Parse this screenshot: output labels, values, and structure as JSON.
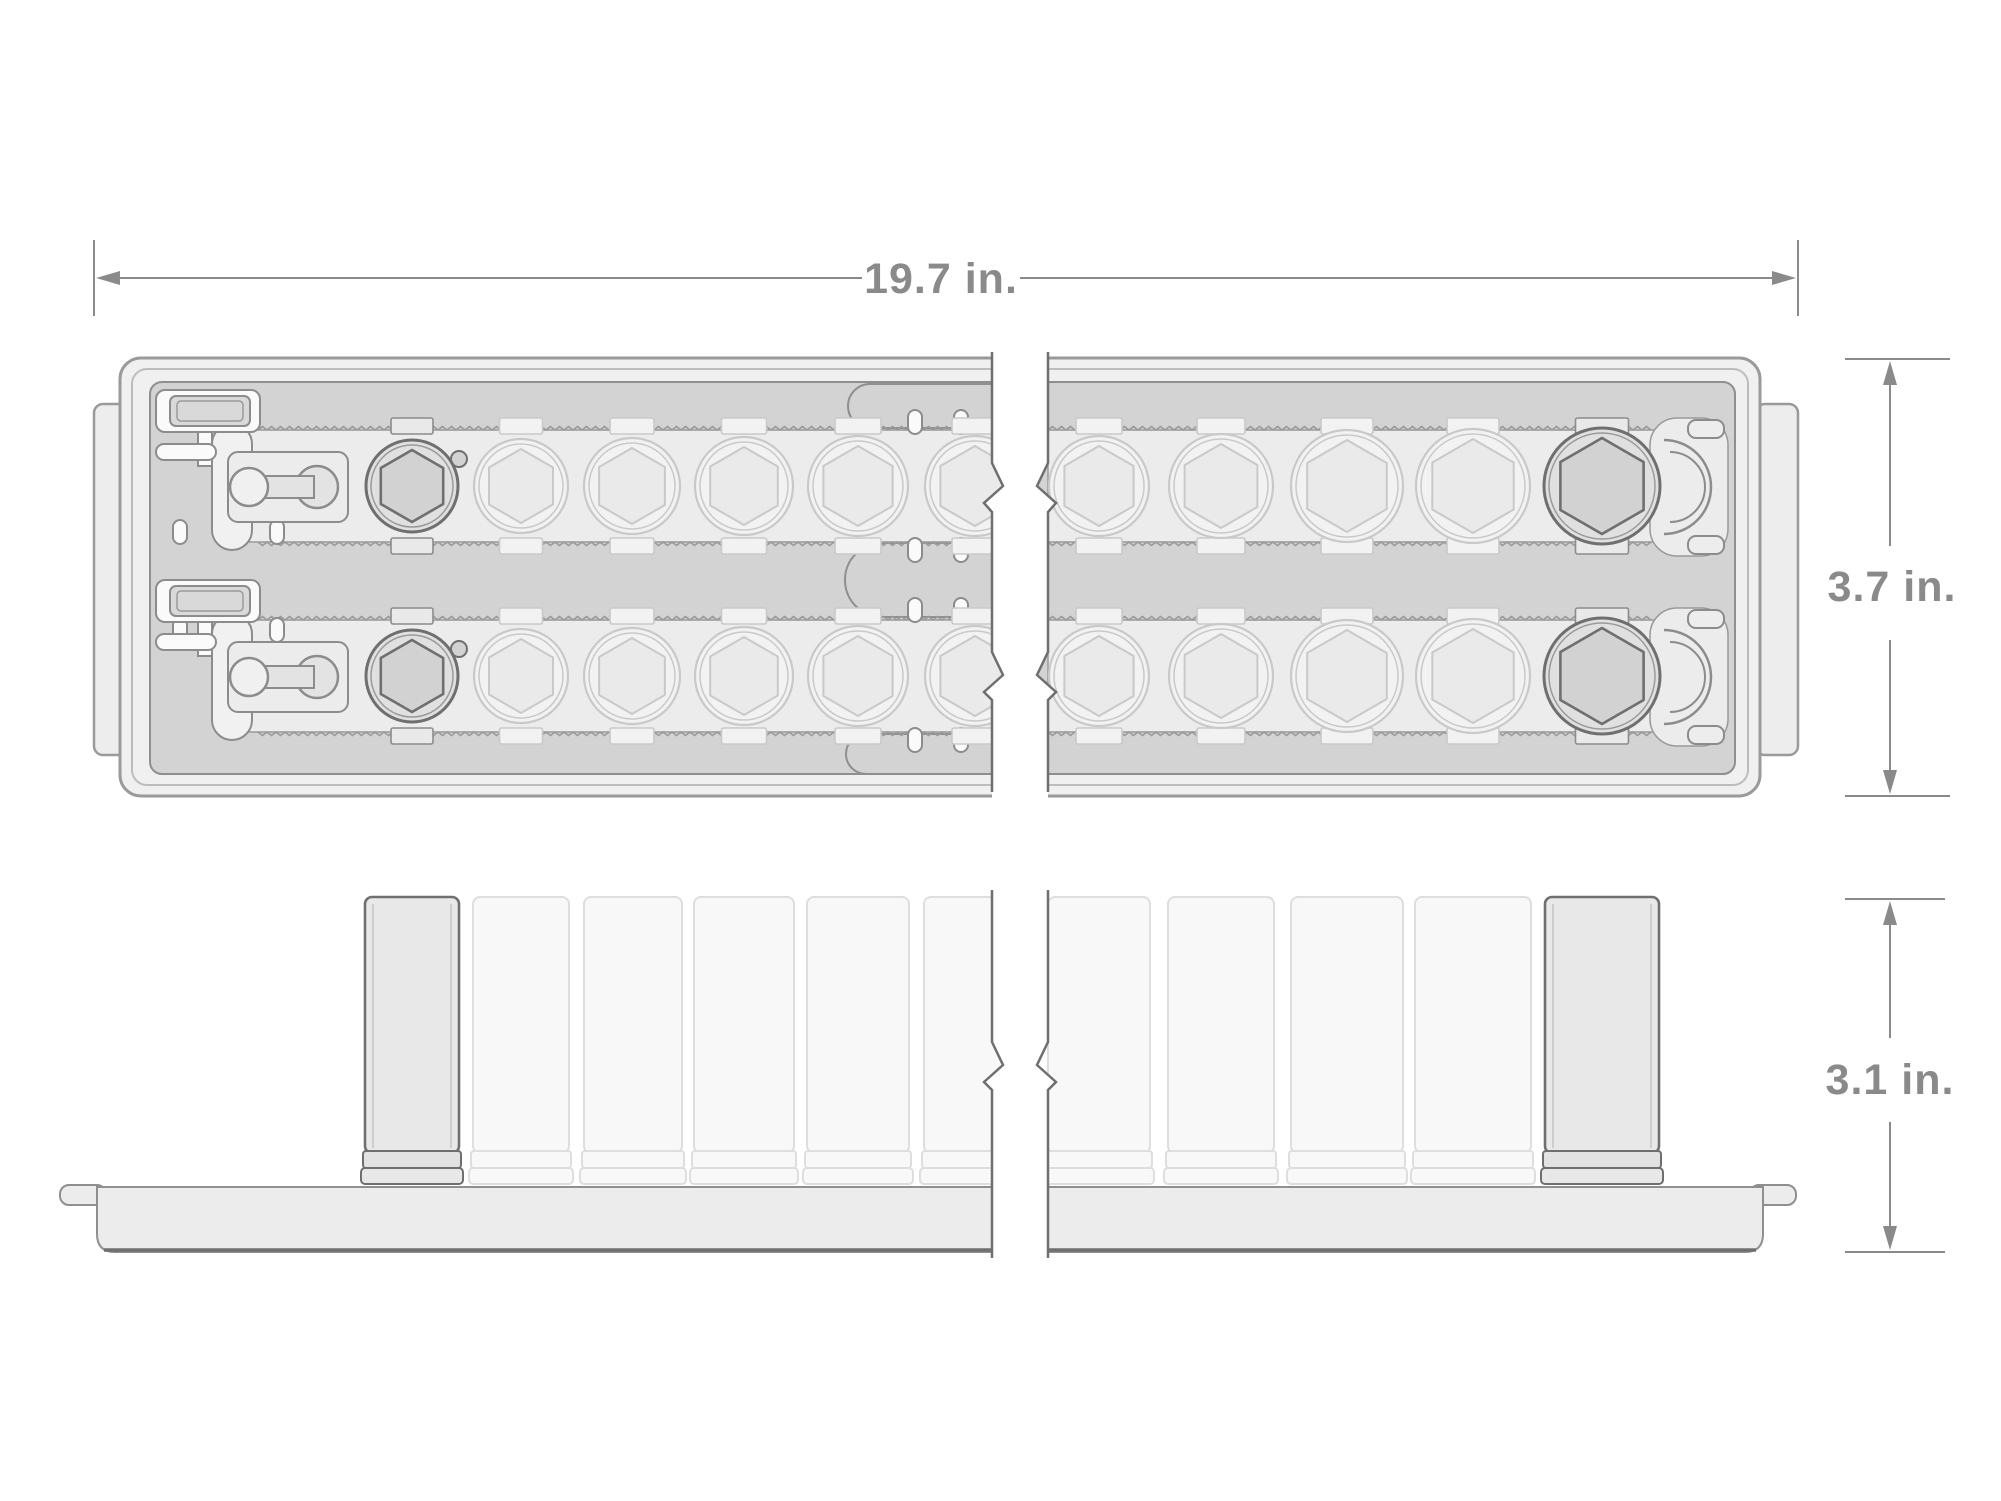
{
  "figure": {
    "type": "technical-dimension-diagram",
    "subject": "socket set storage tray, top view and side view with break marks"
  },
  "dimensions": {
    "width": {
      "label": "19.7 in."
    },
    "depth": {
      "label": "3.7 in."
    },
    "height": {
      "label": "3.1 in."
    }
  },
  "illustration": {
    "colors": {
      "dim": "#8a8a8a",
      "outline": "#8c8c8c",
      "dark_outline": "#6f6f6f",
      "mid_line": "#9a9a9a",
      "tray_rim": "#f0f0f0",
      "field": "#d3d3d3",
      "band": "#ececec",
      "socket_fill": "#e0e0e0",
      "hex_fill": "#d2d2d2",
      "faded_stroke": "#c9c9c9",
      "faded_fill": "#f2f2f2",
      "faded_hex": "#eaeaea",
      "side_dark_fill": "#e8e8e8",
      "side_collar_fill": "#e2e2e2",
      "side_faded_fill": "#f8f8f8",
      "side_faded_stroke": "#dedede",
      "slab": "#ececec",
      "white_part": "#fafafa",
      "clip_fill": "#e9e9e9"
    },
    "rows": [
      {
        "cy": 486,
        "band_top": 430
      },
      {
        "cy": 676,
        "band_top": 620
      }
    ],
    "top_sockets": [
      {
        "cx": 412,
        "r": 46,
        "shade": "dark",
        "nub": true
      },
      {
        "cx": 521,
        "r": 47,
        "shade": "faded"
      },
      {
        "cx": 632,
        "r": 48,
        "shade": "faded"
      },
      {
        "cx": 744,
        "r": 49,
        "shade": "faded"
      },
      {
        "cx": 858,
        "r": 50,
        "shade": "faded"
      },
      {
        "cx": 975,
        "r": 50,
        "shade": "faded"
      },
      {
        "cx": 1099,
        "r": 50,
        "shade": "faded"
      },
      {
        "cx": 1221,
        "r": 52,
        "shade": "faded"
      },
      {
        "cx": 1347,
        "r": 56,
        "shade": "faded"
      },
      {
        "cx": 1473,
        "r": 57,
        "shade": "faded"
      },
      {
        "cx": 1602,
        "r": 58,
        "shade": "dark"
      }
    ],
    "side_sockets": [
      {
        "x": 365,
        "w": 94,
        "shade": "dark"
      },
      {
        "x": 473,
        "w": 96,
        "shade": "faded"
      },
      {
        "x": 584,
        "w": 98,
        "shade": "faded"
      },
      {
        "x": 694,
        "w": 100,
        "shade": "faded"
      },
      {
        "x": 807,
        "w": 102,
        "shade": "faded"
      },
      {
        "x": 924,
        "w": 102,
        "shade": "faded"
      },
      {
        "x": 1048,
        "w": 102,
        "shade": "faded"
      },
      {
        "x": 1168,
        "w": 106,
        "shade": "faded"
      },
      {
        "x": 1291,
        "w": 112,
        "shade": "faded"
      },
      {
        "x": 1415,
        "w": 116,
        "shade": "faded"
      },
      {
        "x": 1545,
        "w": 114,
        "shade": "dark"
      }
    ],
    "serrated_edges": [
      {
        "x1": 258,
        "x2": 1000,
        "y": 430,
        "dir": "up"
      },
      {
        "x1": 1048,
        "x2": 1652,
        "y": 430,
        "dir": "up"
      },
      {
        "x1": 258,
        "x2": 1000,
        "y": 542,
        "dir": "down"
      },
      {
        "x1": 1048,
        "x2": 1652,
        "y": 542,
        "dir": "down"
      },
      {
        "x1": 258,
        "x2": 1000,
        "y": 620,
        "dir": "up"
      },
      {
        "x1": 1048,
        "x2": 1652,
        "y": 620,
        "dir": "up"
      },
      {
        "x1": 258,
        "x2": 1000,
        "y": 732,
        "dir": "down"
      },
      {
        "x1": 1048,
        "x2": 1652,
        "y": 732,
        "dir": "down"
      }
    ],
    "studs": [
      {
        "x": 915,
        "y": 410
      },
      {
        "x": 961,
        "y": 410
      },
      {
        "x": 915,
        "y": 538
      },
      {
        "x": 961,
        "y": 538
      },
      {
        "x": 180,
        "y": 520
      },
      {
        "x": 277,
        "y": 520
      },
      {
        "x": 915,
        "y": 598
      },
      {
        "x": 961,
        "y": 598
      },
      {
        "x": 180,
        "y": 618
      },
      {
        "x": 277,
        "y": 618
      },
      {
        "x": 915,
        "y": 728
      },
      {
        "x": 961,
        "y": 728
      }
    ]
  }
}
